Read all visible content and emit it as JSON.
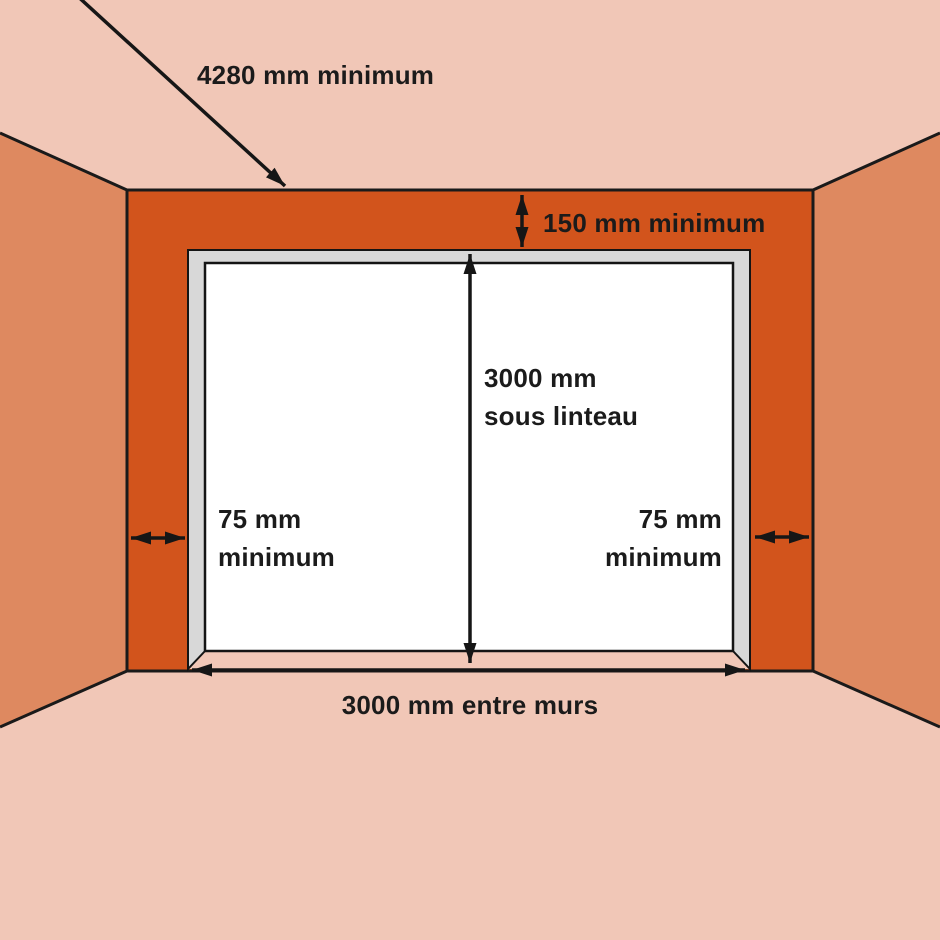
{
  "diagram": {
    "labels": {
      "ceiling_depth": "4280 mm minimum",
      "lintel_clearance": "150 mm minimum",
      "height_line1": "3000 mm",
      "height_line2": "sous linteau",
      "left_clearance_line1": "75 mm",
      "left_clearance_line2": "minimum",
      "right_clearance_line1": "75 mm",
      "right_clearance_line2": "minimum",
      "opening_width": "3000 mm entre murs"
    },
    "colors": {
      "ceiling_floor": "#f1c7b7",
      "side_wall": "#de8960",
      "front_wall": "#d2541c",
      "frame_gray": "#d8d8d8",
      "door_white": "#ffffff",
      "line_black": "#1a1a1a"
    }
  }
}
